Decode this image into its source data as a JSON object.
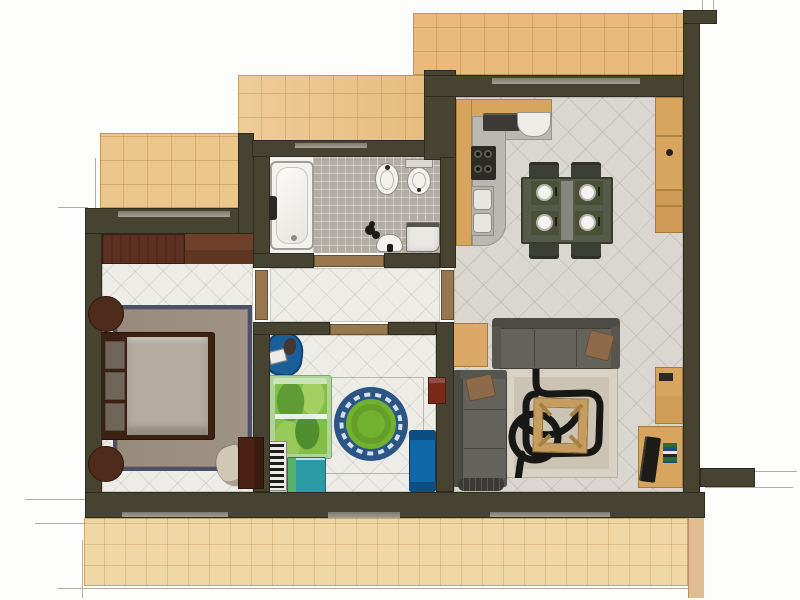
{
  "title": "apartment-floor-plan-render",
  "palette": {
    "wall": "#474331",
    "wall-edge": "#2d2b20",
    "terrace-warm": "#ecc78d",
    "terrace-deep": "#e9ba7c",
    "terrace-pale": "#f0d7a6",
    "terrace-edge-strip": "#e0bd92",
    "tile-line": "rgba(176,122,58,0.38)",
    "floor-white": "#edece6",
    "floor-gray": "#d9d7cf",
    "floor-line": "rgba(120,118,108,0.16)",
    "mosaic": "#b2aea5",
    "porcelain": "#f2f1ed",
    "threshold-wood": "#97774e",
    "window-strip": "#8f8c7f",
    "wood-wardrobe": "#5d3122",
    "wood-wardrobe-light": "#6f4029",
    "wood-dark": "#4a2114",
    "bed-frame": "#3c2113",
    "mattress": "#b3ac9f",
    "pillow-gray": "#6f6558",
    "rug-taupe": "#9e9384",
    "rug-navy": "#4b5166",
    "armchair-beige": "#d2c7b5",
    "sofa-gray": "#63635b",
    "sofa-dark": "#4c4c45",
    "pillow-brown": "#8d6b4a",
    "rug-living": "#d8d2c5",
    "rug-living-inner": "#cbc3b3",
    "ink": "#171715",
    "table-wood": "#c79c60",
    "counter-tan": "#d8a55e",
    "worktop-gray": "#bab8b0",
    "appliance-dark": "#2c2b27",
    "dining-table": "#555a4a",
    "mat-olive": "#4a5038",
    "kids-bed-frame": "#aed49b",
    "kids-duvet": "#82bf47",
    "kids-rug-outer": "#2b5584",
    "kids-rug-wave": "#d7e0e8",
    "kids-rug-inner": "#72b02f",
    "kids-blue": "#1b5f9a",
    "kids-desk": "#1168a8",
    "kids-teal": "#2b9aa4",
    "shelf-red": "#78291a",
    "tv-black": "#1b1b18"
  },
  "rooms": {
    "bedroom": {
      "label": "bedroom",
      "furniture": [
        "wardrobe",
        "double-bed",
        "nightstand",
        "nightstand",
        "area-rug",
        "armchair",
        "dresser"
      ]
    },
    "bathroom": {
      "label": "bathroom",
      "furniture": [
        "bathtub",
        "bidet",
        "toilet",
        "washbasin",
        "washing-machine",
        "toiletries"
      ]
    },
    "hallway": {
      "label": "hallway",
      "furniture": []
    },
    "kids-room": {
      "label": "kids-room",
      "furniture": [
        "lounge-chair",
        "single-bed",
        "bookshelf",
        "cabinet",
        "round-rug",
        "desk",
        "wall-shelf"
      ]
    },
    "kitchen-dining": {
      "label": "kitchen-dining",
      "furniture": [
        "l-shaped-counter",
        "cooktop",
        "stove",
        "double-sink",
        "dining-table",
        "chair",
        "chair",
        "chair",
        "chair",
        "tall-cabinet"
      ]
    },
    "living-room": {
      "label": "living-room",
      "furniture": [
        "corner-sofa",
        "coffee-table",
        "area-rug",
        "tv-desk",
        "tv",
        "shelf-unit",
        "side-table",
        "radiator",
        "book-stack"
      ]
    },
    "terraces": {
      "label": "terraces",
      "count": 4
    }
  }
}
